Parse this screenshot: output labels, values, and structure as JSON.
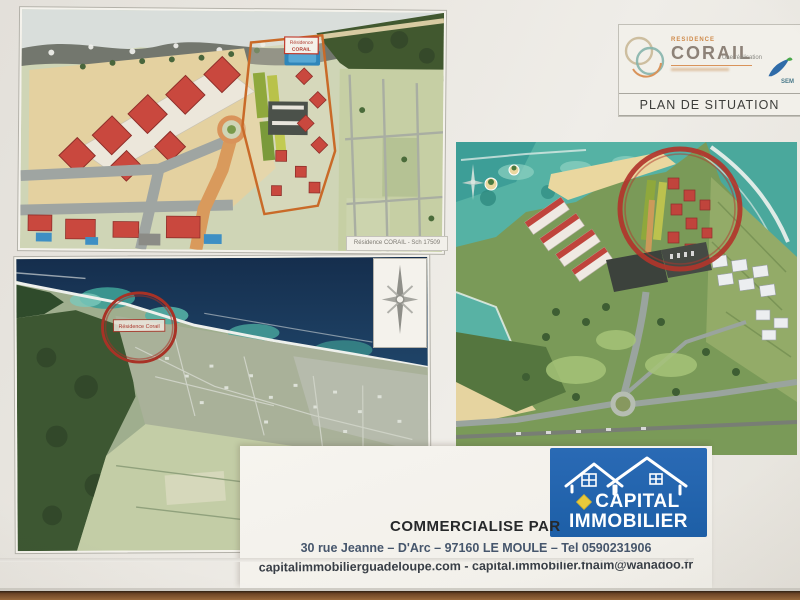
{
  "header": {
    "residence_pre": "RESIDENCE",
    "residence_name": "CORAIL",
    "realisation_label": "Une réalisation",
    "realisation_company": "SEM",
    "plan_title": "PLAN DE SITUATION"
  },
  "site_plan_map": {
    "caption": "Résidence CORAIL - Sch 17509",
    "parcel_label_line1": "Résidence",
    "parcel_label_line2": "CORAIL"
  },
  "town_map": {
    "circle_label": "Résidence Corail"
  },
  "footer": {
    "commercialise": "COMMERCIALISE PAR",
    "agency_line1": "CAPITAL",
    "agency_line2": "IMMOBILIER",
    "address": "30 rue Jeanne – D'Arc – 97160 LE MOULE – Tel  0590231906",
    "contact": "capitalimmobilierguadeloupe.com - capital.immobilier.fnaim@wanadoo.fr"
  },
  "icons": {
    "compass_rose": "eight-point star",
    "house_outline": "double house roofline",
    "fnaim_diamond": "yellow lozenge",
    "corail_rings": "interlocking thin rings",
    "sem_bird": "blue-green swoosh bird"
  },
  "colors": {
    "highlight_red": "#b1352b",
    "agency_blue": "#1d5fa7",
    "fnaim_yellow": "#e9c93c",
    "corail_orange": "#d9935a",
    "ocean_navy": "#1b3a5e",
    "lagoon_teal": "#55b2a4"
  }
}
